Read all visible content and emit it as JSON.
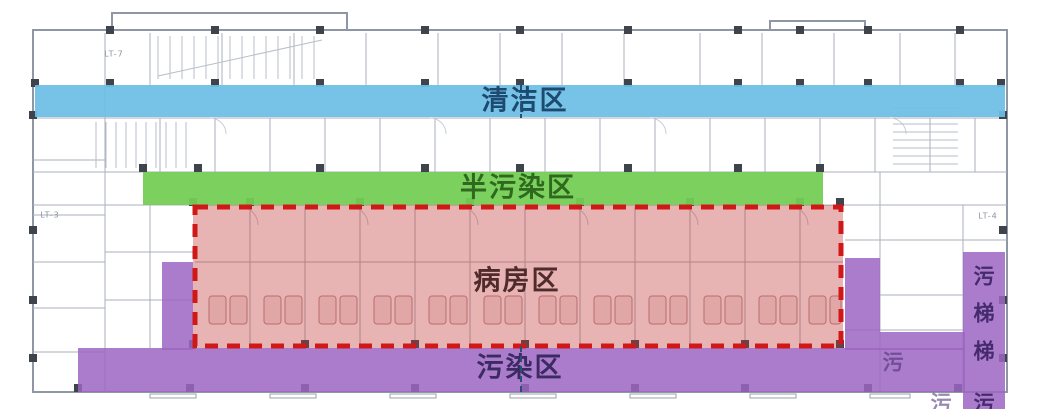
{
  "figure": {
    "kind": "hospital-ward-floor-plan-zoning",
    "width": 1044,
    "height": 409
  },
  "zones": {
    "clean": {
      "label": "清洁区",
      "fill": "rgba(109,190,229,0.93)",
      "text_color": "#1d4a70",
      "rect": {
        "x": 35,
        "y": 85,
        "w": 970,
        "h": 32
      },
      "label_pos": {
        "x": 525,
        "y": 101
      }
    },
    "semi": {
      "label": "半污染区",
      "fill": "rgba(116,206,84,0.94)",
      "text_color": "#2e691d",
      "rect": {
        "x": 143,
        "y": 172,
        "w": 680,
        "h": 33
      },
      "label_pos": {
        "x": 518,
        "y": 188
      }
    },
    "ward": {
      "label": "病房区",
      "fill": "rgba(192,55,55,0.38)",
      "border_color": "#d01818",
      "text_color": "#4f2b2b",
      "rect": {
        "x": 193,
        "y": 205,
        "w": 650,
        "h": 143
      },
      "label_pos": {
        "x": 517,
        "y": 281
      }
    },
    "dirty": {
      "label": "污染区",
      "fill": "rgba(156,101,194,0.85)",
      "text_color": "#3c2a63",
      "label_pos": {
        "x": 520,
        "y": 368
      },
      "rects": [
        {
          "x": 78,
          "y": 348,
          "w": 887,
          "h": 44
        },
        {
          "x": 162,
          "y": 262,
          "w": 31,
          "h": 88
        },
        {
          "x": 845,
          "y": 258,
          "w": 35,
          "h": 92
        },
        {
          "x": 880,
          "y": 332,
          "w": 85,
          "h": 18
        },
        {
          "x": 963,
          "y": 252,
          "w": 42,
          "h": 157
        }
      ]
    }
  },
  "dirty_elevator": {
    "label": "污梯",
    "text_color": "#452a6e",
    "x": 984,
    "chars": [
      "污",
      "梯",
      "梯",
      "污"
    ],
    "char_ys": [
      277,
      314,
      352,
      404
    ],
    "faint_chars": [
      {
        "t": "污",
        "x": 893,
        "y": 363
      },
      {
        "t": "污",
        "x": 941,
        "y": 404
      }
    ]
  },
  "annotations": [
    {
      "text": "LT-7",
      "x": 114,
      "y": 54
    },
    {
      "text": "LT-3",
      "x": 50,
      "y": 215
    },
    {
      "text": "LT-4",
      "x": 988,
      "y": 216
    }
  ]
}
